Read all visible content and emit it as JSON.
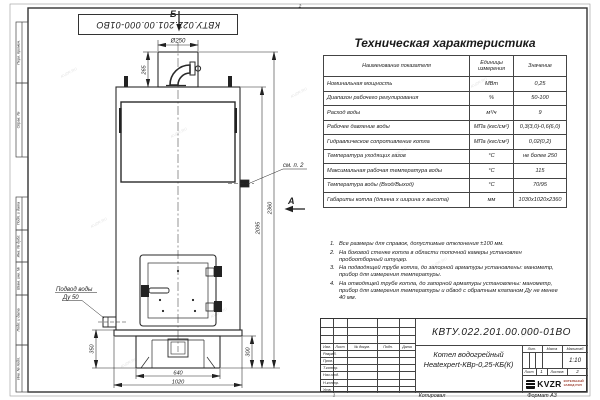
{
  "sheet": {
    "doc_number": "КВТУ.022.201.00.000-01ВО",
    "watermark": "KVZR.RU",
    "zone_top": "2",
    "zone_bottom": "1",
    "copied_label": "Копировал",
    "format_label": "Формат А3"
  },
  "frame_stamps": [
    "Перв. примен.",
    "Справ. №",
    "Подп. и дата",
    "Инв. № дубл.",
    "Взам. инв. №",
    "Подп. и дата",
    "Инв. № подл."
  ],
  "drawing": {
    "view_b_label": "Б",
    "view_a_label": "А",
    "dim_diameter": "Ø250",
    "dim_265": "265",
    "dim_2095": "2095",
    "dim_2360": "2360",
    "dim_350": "350",
    "dim_300": "300",
    "dim_640": "640",
    "dim_1020": "1020",
    "see_note_label": "см. п. 2",
    "water_inlet_line1": "Подвод воды",
    "water_inlet_line2": "Ду 50"
  },
  "table": {
    "title": "Техническая характеристика",
    "headers": [
      "Наименование показателя",
      "Единицы измерения",
      "Значение"
    ],
    "rows": [
      {
        "name": "Номинальная мощность",
        "unit": "МВт",
        "value": "0,25"
      },
      {
        "name": "Диапазон рабочего регулирования",
        "unit": "%",
        "value": "50-100"
      },
      {
        "name": "Расход воды",
        "unit": "м³/ч",
        "value": "9"
      },
      {
        "name": "Рабочее давление воды",
        "unit": "МПа (кгс/см²)",
        "value": "0,3(3,0)-0,6(6,0)"
      },
      {
        "name": "Гидравлическое сопротивление котла",
        "unit": "МПа (кгс/см²)",
        "value": "0,02(0,2)"
      },
      {
        "name": "Температура уходящих газов",
        "unit": "°С",
        "value": "не более 250"
      },
      {
        "name": "Максимальная рабочая температура воды",
        "unit": "°С",
        "value": "115"
      },
      {
        "name": "Температура воды (Вход/Выход)",
        "unit": "°С",
        "value": "70/95"
      },
      {
        "name": "Габариты котла (длинна х ширина х высота)",
        "unit": "мм",
        "value": "1030х1020х2360"
      }
    ]
  },
  "notes": {
    "items": [
      {
        "num": "1.",
        "text": "Все размеры для справок, допустимые отклонения ±100 мм."
      },
      {
        "num": "2.",
        "text": "На боковой стенке котла в области топочной камеры установлен пробоотборный штуцер."
      },
      {
        "num": "3.",
        "text": "На подводящей трубе котла, до запорной арматуры установлены: манометр, прибор для измерения температуры."
      },
      {
        "num": "4.",
        "text": "На отводящей трубе котла, до запорной арматуры установлены: манометр, прибор для измерения температуры и обвод с обратным клапаном Ду не менее 40 мм."
      }
    ]
  },
  "title_block": {
    "doc_number": "КВТУ.022.201.00.000-01ВО",
    "product_name_1": "Котел водогрейный",
    "product_name_2": "Heatexpert-КВр-0,25-КБ(К)",
    "col_izm": "Изм.",
    "col_list": "Лист",
    "col_docnum": "№ докум.",
    "col_podp": "Подп.",
    "col_data": "Дата",
    "row_razrab": "Разраб.",
    "row_prov": "Пров.",
    "row_tkontr": "Т.контр.",
    "row_nachotd": "Нач.отд.",
    "row_nkontr": "Н.контр.",
    "row_utv": "Утв.",
    "lit_label": "Лит.",
    "mass_label": "Масса",
    "scale_label": "Масштаб",
    "scale_value": "1:10",
    "sheet_label": "Лист",
    "sheet_value": "1",
    "sheets_label": "Листов",
    "sheets_value": "2",
    "logo_text": "KVZR",
    "company_line1": "КОТЕЛЬНЫЙ",
    "company_line2": "ЗАВОД РЭП",
    "company_color": "#9c3b2b"
  }
}
